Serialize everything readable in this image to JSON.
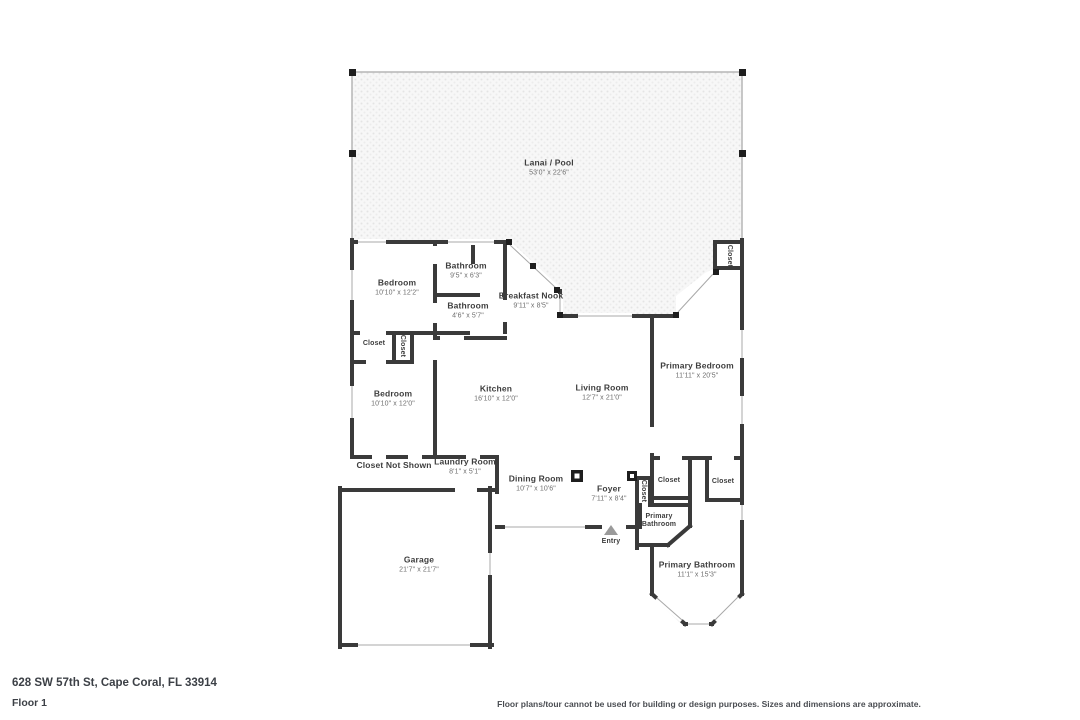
{
  "page": {
    "address": "628 SW 57th St, Cape Coral, FL 33914",
    "floor_label": "Floor 1",
    "disclaimer": "Floor plans/tour cannot be used for building or design purposes. Sizes and dimensions are approximate."
  },
  "colors": {
    "wall": "#3a3a3a",
    "label_text": "#3e3e3e",
    "dimension_text": "#6e6e6e",
    "lanai_dot": "#e4e4e4",
    "lanai_bg": "#f7f7f7",
    "entry_arrow": "#9a9a9a"
  },
  "rooms": [
    {
      "name": "Lanai / Pool",
      "dims": "53'0\" x 22'6\""
    },
    {
      "name": "Bathroom",
      "dims": "9'5\" x 6'3\""
    },
    {
      "name": "Bedroom",
      "dims": "10'10\" x 12'2\""
    },
    {
      "name": "Bathroom",
      "dims": "4'6\" x 5'7\""
    },
    {
      "name": "Breakfast Nook",
      "dims": "9'11\" x 8'5\""
    },
    {
      "name": "Closet"
    },
    {
      "name": "Closet"
    },
    {
      "name": "Closet"
    },
    {
      "name": "Primary Bedroom",
      "dims": "11'11\" x 20'5\""
    },
    {
      "name": "Bedroom",
      "dims": "10'10\" x 12'0\""
    },
    {
      "name": "Kitchen",
      "dims": "16'10\" x 12'0\""
    },
    {
      "name": "Living Room",
      "dims": "12'7\" x 21'0\""
    },
    {
      "name": "Closet Not Shown"
    },
    {
      "name": "Laundry Room",
      "dims": "8'1\" x 5'1\""
    },
    {
      "name": "Dining Room",
      "dims": "10'7\" x 10'6\""
    },
    {
      "name": "Foyer",
      "dims": "7'11\" x 8'4\""
    },
    {
      "name": "Closet"
    },
    {
      "name": "Closet"
    },
    {
      "name": "Closet"
    },
    {
      "name": "Primary Bathroom"
    },
    {
      "name": "Entry"
    },
    {
      "name": "Primary Bathroom",
      "dims": "11'1\" x 15'3\""
    },
    {
      "name": "Garage",
      "dims": "21'7\" x 21'7\""
    }
  ]
}
